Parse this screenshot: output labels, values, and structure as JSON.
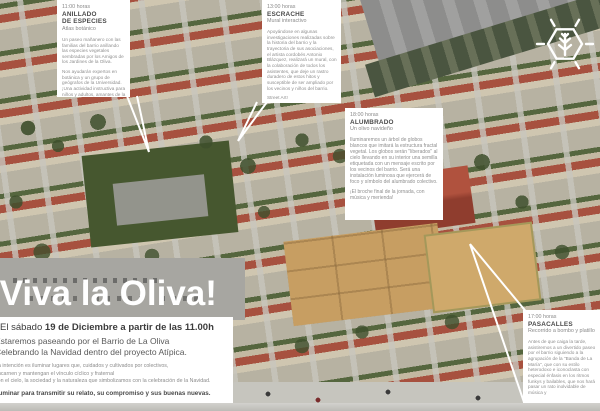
{
  "poster": {
    "title": "¡Viva la Oliva!",
    "logo_icon": "hexagon-tree-logo"
  },
  "colors": {
    "callout_bg": "#ffffff",
    "title_color": "#ffffff",
    "text_dark": "#4a4a4a",
    "text_muted": "#8c8c8c"
  },
  "callouts": [
    {
      "time": "11:00 horas",
      "title": "ANILLADO",
      "title2": "DE ESPECIES",
      "subtitle": "Atlas botánico",
      "paragraphs": [
        "Un paseo mañanero con las familias del barrio anillando las especies vegetales sembradas por los Amigos de los Jardines de la Oliva.",
        "Nos ayudarán expertos en botánica y un grupo de geógrafos de la Universidad. ¡Una actividad instructiva para niños y adultos, amantes de la Naturaleza y la Tecnología!"
      ]
    },
    {
      "time": "13:00 horas",
      "title": "ESCRACHE",
      "subtitle": "Mural interactivo",
      "paragraphs": [
        "Apoyándose en algunas investigaciones realizadas sobre la historia del barrio y la trayectoria de sus asociaciones, el artista cordobés Antonio Blázquez, realizará un mural, con la colaboración de todos los asistentes, que deje un rastro duradero de estos hitos y susceptible de ser ampliado por los vecinos y niños del barrio.",
        "Street Art!"
      ]
    },
    {
      "time": "18:00 horas",
      "title": "ALUMBRADO",
      "subtitle": "Un olivo navideño",
      "paragraphs": [
        "Iluminaremos un árbol de globos blancos que imitará la estructura fractal vegetal. Los globos serán \"liberados\" al cielo llevando en su interior una semilla etiquetada con un mensaje escrito por los vecinos del barrio. Será una instalación luminosa que ejercerá de foco y símbolo del alumbrado colectivo.",
        "¡El broche final de la jornada, con música y merienda!"
      ]
    },
    {
      "time": "17:00 horas",
      "title": "PASACALLES",
      "subtitle": "Recorrido a bombo y platillo",
      "paragraphs": [
        "Antes de que caiga la tarde, asistiremos a un divertido paseo por el barrio siguiendo a la agrupación de la \"Banda de La María\", que con su estilo heterodoxo e iconoclasta con especial énfasis en los ritmos funkys y bailables, que nos hará pasar un rato inolvidable de música y"
      ]
    }
  ],
  "footer": {
    "date_prefix": "El sábado ",
    "date_bold": "19 de Diciembre a partir de las 11.00h",
    "line2": "Estaremos paseando por el Barrio de La Oliva",
    "line3": "Celebrando la Navidad dentro del proyecto Atípica.",
    "small_lines": [
      "La intención es iluminar lugares que, cuidados y cultivados por colectivos,",
      "encarnen y mantengan el vínculo cíclico y fraternal",
      "con el cielo, la sociedad y la naturaleza que simbolizamos con la celebración de la Navidad."
    ],
    "small_bold": "Iluminar para transmitir su relato, su compromiso y sus buenas nuevas."
  }
}
